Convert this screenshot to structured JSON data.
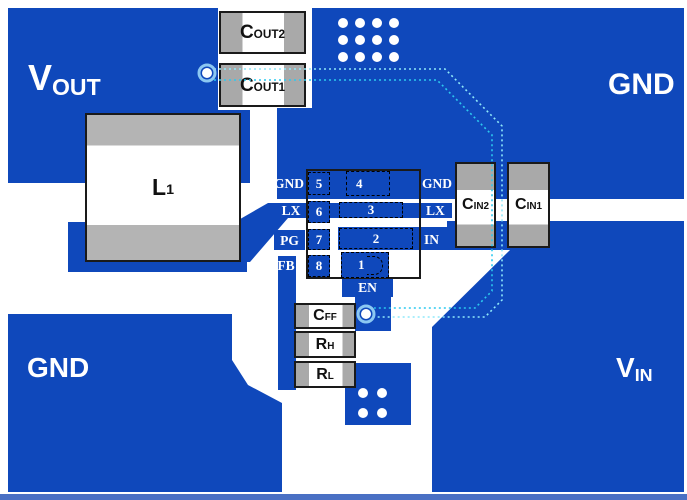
{
  "title": "DC-DC converter EVM PCB layout",
  "colors": {
    "copper_blue": "#0f48bb",
    "component_gray": "#a9a9a9",
    "board_white": "#ffffff",
    "trace_cyan_outer": "#8fe9fa",
    "trace_cyan_inner": "#2cc9ef",
    "via_white": "#ffffff",
    "via_halo": "#8cc8f2",
    "bottom_strip_blue": "#4a70c4"
  },
  "net_labels": {
    "vout": {
      "main": "V",
      "sub": "OUT"
    },
    "gnd_top": "GND",
    "gnd_bottom": "GND",
    "vin": {
      "main": "V",
      "sub": "IN"
    }
  },
  "components": {
    "cout2": {
      "main": "C",
      "sub": "OUT2"
    },
    "cout1": {
      "main": "C",
      "sub": "OUT1"
    },
    "cin2": {
      "main": "C",
      "sub": "IN2"
    },
    "cin1": {
      "main": "C",
      "sub": "IN1"
    },
    "l1": {
      "main": "L",
      "sub": "1"
    },
    "cff": {
      "main": "C",
      "sub": "FF"
    },
    "rh": {
      "main": "R",
      "sub": "H"
    },
    "rl": {
      "main": "R",
      "sub": "L"
    }
  },
  "ic": {
    "pin5": {
      "number": "5",
      "name": "GND"
    },
    "pin6": {
      "number": "6",
      "name": "LX"
    },
    "pin7": {
      "number": "7",
      "name": "PG"
    },
    "pin8": {
      "number": "8",
      "name": "FB"
    },
    "pin4": {
      "number": "4",
      "name": "GND"
    },
    "pin3": {
      "number": "3",
      "name": "LX"
    },
    "pin2": {
      "number": "2",
      "name": "IN"
    },
    "pin1": {
      "number": "1",
      "name": "EN"
    }
  }
}
